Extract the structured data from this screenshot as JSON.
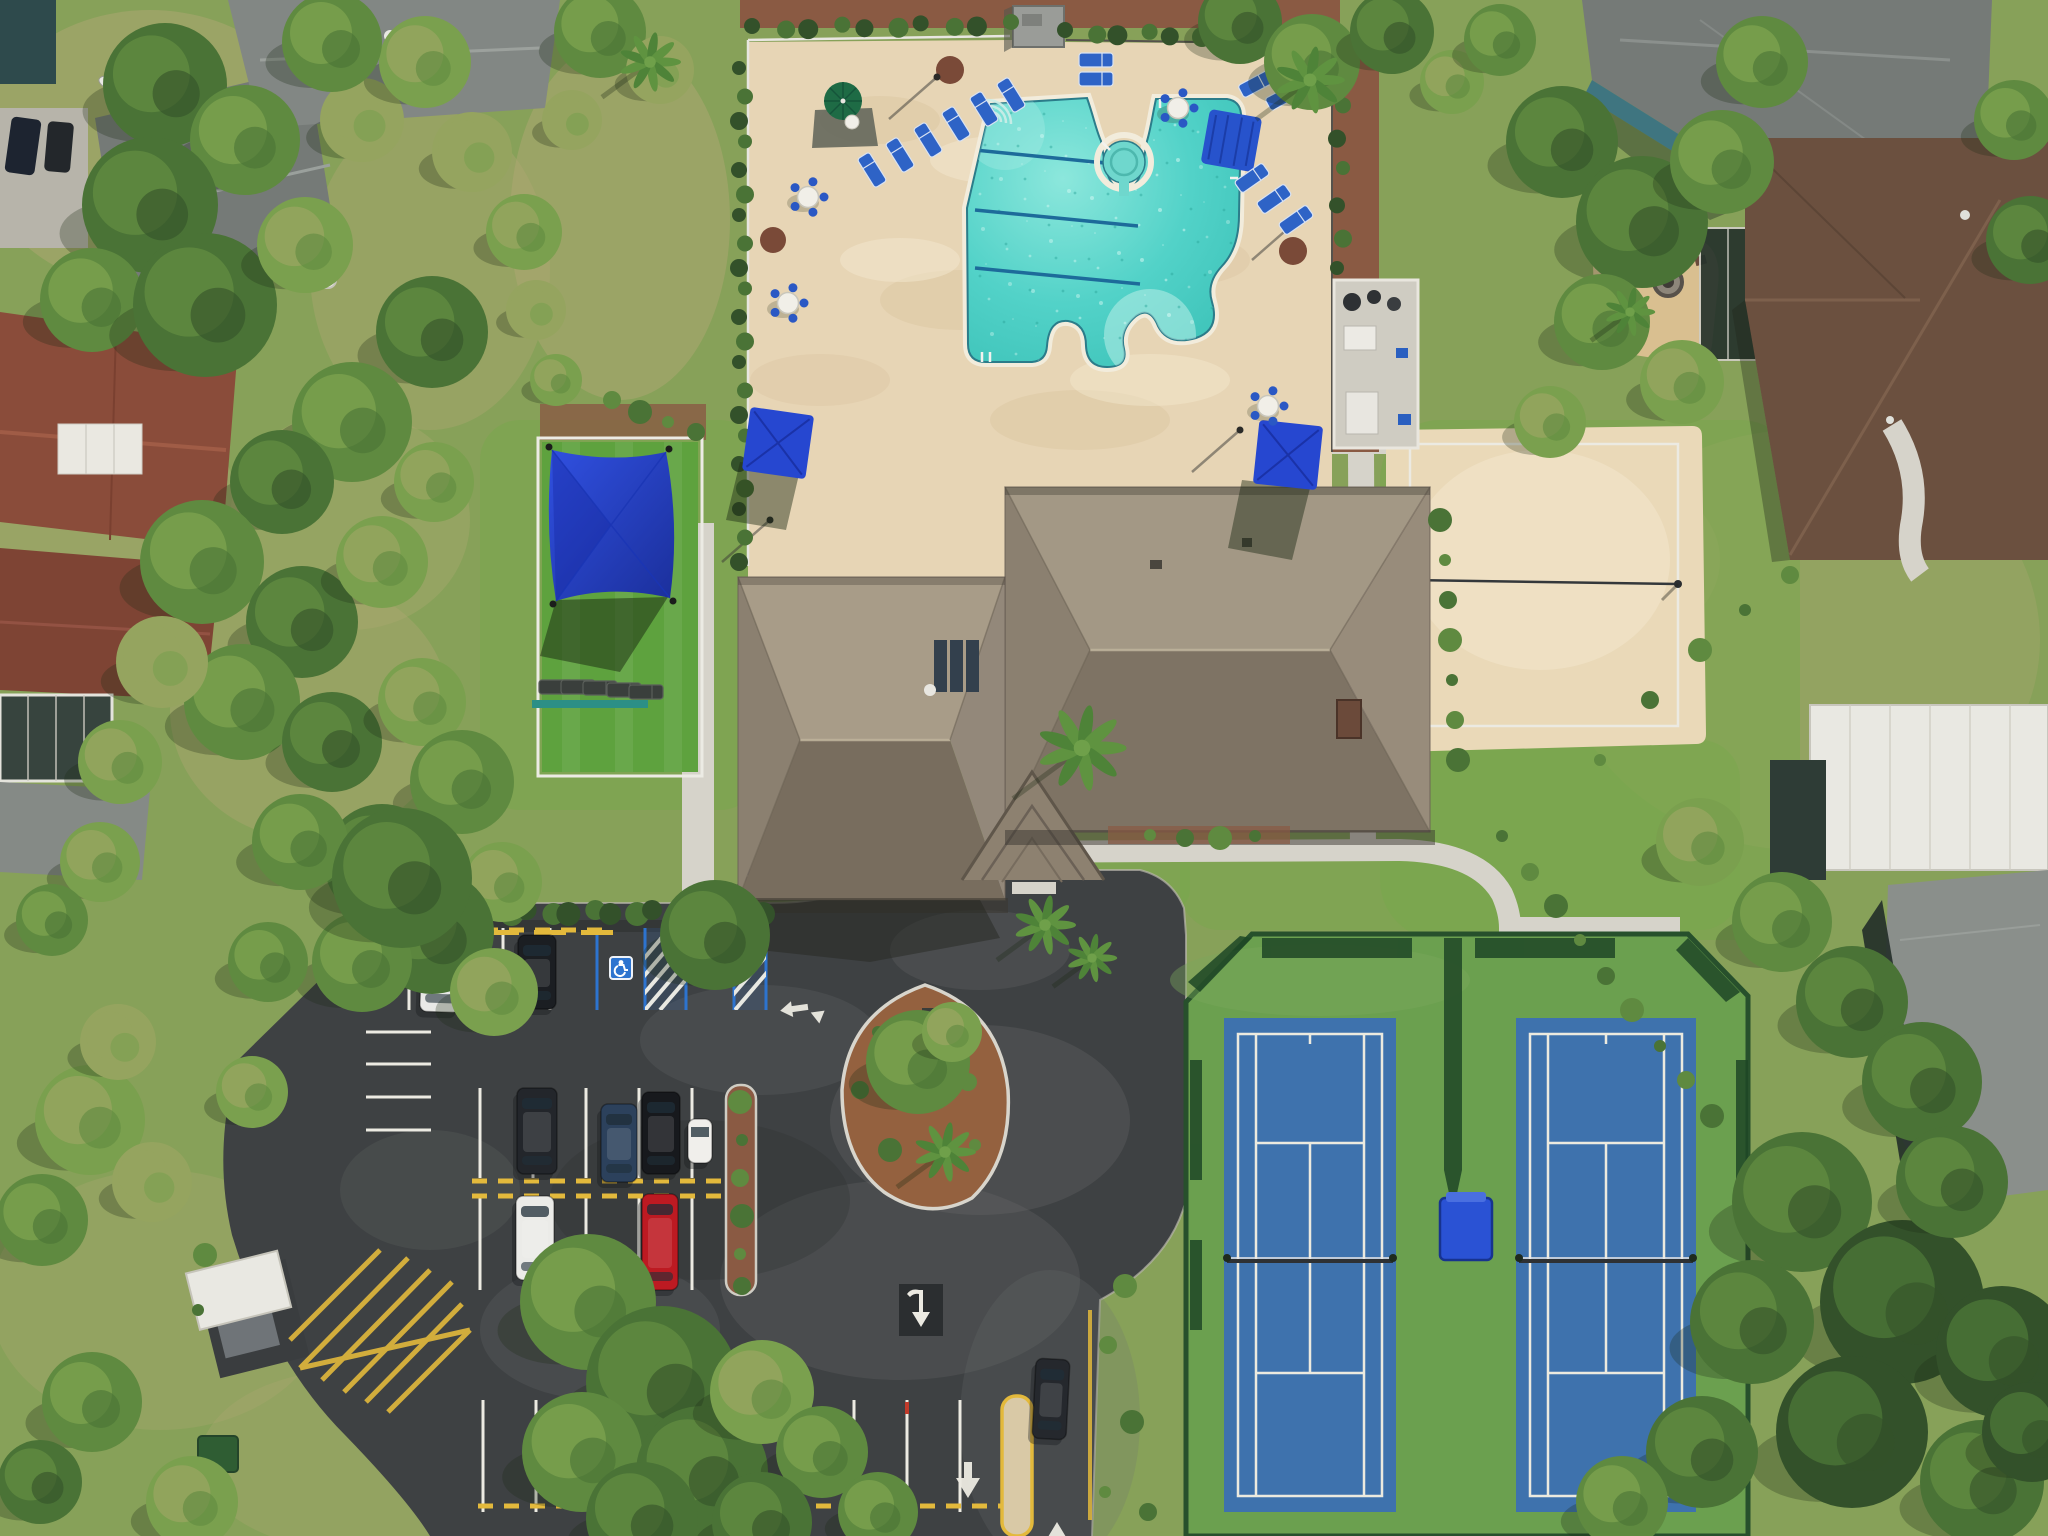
{
  "meta": {
    "type": "aerial-drone-photo",
    "description": "Overhead aerial view of a community amenity center: free-form swimming pool with lap lanes and spa on a tan deck, taupe hip-roof clubhouse, playground with blue shade sail, sand volleyball court, two blue tennis courts in a green enclosure, and an asphalt parking lot with cars, surrounded by residential houses and trees."
  },
  "colors": {
    "grass_base": "#87a159",
    "grass_bright": "#78a84c",
    "turf": "#5ea23e",
    "grass_dry": "#b0a873",
    "mulch": "#8a5a43",
    "deck": "#e7d5b5",
    "concrete": "#d6d3ca",
    "asphalt": "#3e4143",
    "asphalt_worn": "#6e7170",
    "line_white": "#eceae2",
    "line_yellow": "#e3b93c",
    "handicap_blue": "#2d74cf",
    "pool_water": "#52d2c8",
    "spa_water": "#6fd7cd",
    "lane_blue": "#1d6b9a",
    "coping": "#f2ecdc",
    "sand": "#ead9b8",
    "tennis_green": "#6ba04f",
    "tennis_blue": "#3e72ad",
    "fence_green": "#27502c",
    "roof_taupe": "#93887a",
    "roof_gray": "#757a77",
    "roof_brown": "#8a4c3a",
    "roof_dkbrown": "#6b503f",
    "white_struct": "#e9e8e2",
    "teal_wall": "#3f7580",
    "furniture_blue": "#2e63c6",
    "umbrella_royal": "#2647d0",
    "umbrella_green": "#1e6b45",
    "sail_blue": "#2b49d6"
  },
  "scene": {
    "amenities": [
      "swimming pool with 3 lap lanes",
      "round spa",
      "clubhouse",
      "playground with shade sail",
      "sand volleyball court",
      "two tennis courts",
      "parking lot",
      "gated pool deck"
    ],
    "pool": {
      "lap_lanes": 3,
      "loungers": [
        [
          872,
          170,
          -32
        ],
        [
          900,
          155,
          -32
        ],
        [
          928,
          140,
          -32
        ],
        [
          956,
          124,
          -32
        ],
        [
          984,
          109,
          -32
        ],
        [
          1011,
          95,
          -32
        ],
        [
          1096,
          60,
          90
        ],
        [
          1096,
          79,
          90
        ],
        [
          1256,
          84,
          62
        ],
        [
          1283,
          97,
          62
        ],
        [
          1252,
          178,
          55
        ],
        [
          1274,
          199,
          55
        ],
        [
          1296,
          220,
          55
        ]
      ],
      "tables": [
        [
          808,
          197
        ],
        [
          788,
          303
        ],
        [
          1178,
          108
        ],
        [
          1268,
          406
        ]
      ],
      "umbrellas": {
        "green_round": 1,
        "blue_square": 2,
        "blue_cabana": 1
      },
      "planter_circles": [
        [
          950,
          70,
          14
        ],
        [
          773,
          240,
          13
        ],
        [
          1293,
          251,
          14
        ]
      ],
      "light_poles": [
        [
          937,
          77
        ],
        [
          1300,
          218
        ],
        [
          770,
          520
        ],
        [
          1240,
          430
        ]
      ]
    },
    "playground": {
      "shade_sail": true,
      "loungers": [
        [
          556,
          687,
          90
        ],
        [
          578,
          687,
          90
        ],
        [
          600,
          688,
          90
        ],
        [
          624,
          690,
          90
        ],
        [
          646,
          692,
          90
        ]
      ]
    },
    "volleyball": {
      "surface": "sand",
      "net": true
    },
    "tennis": {
      "court_count": 2,
      "courts": [
        {
          "x": 1224,
          "w": 172
        },
        {
          "x": 1516,
          "w": 180
        }
      ],
      "y": 1018,
      "h": 494,
      "net_y": 1258,
      "divider_curtain": true,
      "ball_box": true
    },
    "parking": {
      "handicap_spaces": 2,
      "vehicles": [
        {
          "name": "white-sedan",
          "x": 441,
          "y": 974,
          "w": 40,
          "h": 76,
          "rot": 2,
          "color": "#e9e9e7"
        },
        {
          "name": "dark-sedan",
          "x": 537,
          "y": 972,
          "w": 38,
          "h": 74,
          "rot": 0,
          "color": "#1b1e22"
        },
        {
          "name": "black-suv",
          "x": 537,
          "y": 1131,
          "w": 40,
          "h": 86,
          "rot": 0,
          "color": "#23262b"
        },
        {
          "name": "blue-sedan",
          "x": 619,
          "y": 1143,
          "w": 36,
          "h": 78,
          "rot": 0,
          "color": "#2c415c"
        },
        {
          "name": "black-suv-2",
          "x": 661,
          "y": 1133,
          "w": 38,
          "h": 82,
          "rot": 0,
          "color": "#17191d"
        },
        {
          "name": "golf-cart",
          "x": 700,
          "y": 1141,
          "w": 24,
          "h": 44,
          "rot": 0,
          "color": "#f0efeb"
        },
        {
          "name": "white-sedan-2",
          "x": 535,
          "y": 1238,
          "w": 38,
          "h": 84,
          "rot": 0,
          "color": "#ebebe8"
        },
        {
          "name": "red-truck",
          "x": 660,
          "y": 1242,
          "w": 36,
          "h": 96,
          "rot": 0,
          "color": "#bd1a22"
        },
        {
          "name": "exiting-car",
          "x": 1051,
          "y": 1399,
          "w": 34,
          "h": 80,
          "rot": 3,
          "color": "#25282d"
        }
      ],
      "rows": {
        "top": {
          "y1": 928,
          "y2": 1010,
          "x": [
            409,
            456,
            503,
            550
          ]
        },
        "top_blue": {
          "y1": 928,
          "y2": 1010,
          "x": [
            597,
            645,
            686,
            734,
            766
          ],
          "hatch": [
            [
              645,
              686
            ],
            [
              734,
              766
            ]
          ],
          "icons": [
            621,
            710
          ]
        },
        "mid_upper": {
          "y1": 1088,
          "y2": 1178,
          "x": [
            480,
            533,
            586,
            639,
            692,
            745
          ]
        },
        "mid_lower": {
          "y1": 1198,
          "y2": 1290,
          "x": [
            480,
            533,
            586,
            639,
            692,
            745
          ]
        },
        "bottom": {
          "y1": 1400,
          "y2": 1512,
          "x": [
            483,
            536,
            589,
            642,
            695,
            748,
            801,
            854,
            907,
            960
          ]
        },
        "west": {
          "x1": 366,
          "x2": 431,
          "ys": [
            1032,
            1064,
            1097,
            1130
          ]
        }
      },
      "yellow_dashes": [
        {
          "y": 930,
          "x1": 405,
          "x2": 596
        },
        {
          "y": 1181,
          "x1": 472,
          "x2": 750
        },
        {
          "y": 1196,
          "x1": 472,
          "x2": 750
        },
        {
          "y": 1506,
          "x1": 478,
          "x2": 1006
        }
      ],
      "pavement_arrows": 4,
      "speed_bump": true,
      "dumpster_enclosure": true
    },
    "vegetation": {
      "trees": [
        [
          165,
          85,
          62,
          1
        ],
        [
          245,
          140,
          55,
          2
        ],
        [
          150,
          205,
          68,
          1
        ],
        [
          92,
          300,
          52,
          2
        ],
        [
          205,
          305,
          72,
          1
        ],
        [
          305,
          245,
          48,
          3
        ],
        [
          362,
          120,
          42,
          4
        ],
        [
          425,
          62,
          46,
          3
        ],
        [
          332,
          42,
          50,
          2
        ],
        [
          472,
          152,
          40,
          4
        ],
        [
          524,
          232,
          38,
          3
        ],
        [
          432,
          332,
          56,
          1
        ],
        [
          352,
          422,
          60,
          2
        ],
        [
          282,
          482,
          52,
          1
        ],
        [
          202,
          562,
          62,
          2
        ],
        [
          302,
          622,
          56,
          1
        ],
        [
          382,
          562,
          46,
          3
        ],
        [
          434,
          482,
          40,
          3
        ],
        [
          242,
          702,
          58,
          2
        ],
        [
          332,
          742,
          50,
          1
        ],
        [
          422,
          702,
          44,
          3
        ],
        [
          162,
          662,
          46,
          4
        ],
        [
          120,
          762,
          42,
          3
        ],
        [
          462,
          782,
          52,
          2
        ],
        [
          382,
          862,
          58,
          1
        ],
        [
          300,
          842,
          48,
          2
        ],
        [
          502,
          882,
          40,
          3
        ],
        [
          432,
          932,
          62,
          1
        ],
        [
          362,
          962,
          50,
          2
        ],
        [
          494,
          992,
          44,
          3
        ],
        [
          402,
          878,
          70,
          1
        ],
        [
          90,
          1120,
          55,
          3
        ],
        [
          42,
          1220,
          46,
          2
        ],
        [
          152,
          1182,
          40,
          4
        ],
        [
          252,
          1092,
          36,
          3
        ],
        [
          92,
          1402,
          50,
          2
        ],
        [
          40,
          1482,
          42,
          1
        ],
        [
          192,
          1502,
          46,
          3
        ],
        [
          118,
          1042,
          38,
          4
        ],
        [
          588,
          1302,
          68,
          2
        ],
        [
          662,
          1382,
          76,
          1
        ],
        [
          582,
          1452,
          60,
          2
        ],
        [
          702,
          1472,
          66,
          1
        ],
        [
          762,
          1392,
          52,
          3
        ],
        [
          642,
          1518,
          56,
          1
        ],
        [
          822,
          1452,
          46,
          2
        ],
        [
          762,
          1522,
          50,
          1
        ],
        [
          878,
          1512,
          40,
          2
        ],
        [
          918,
          1062,
          52,
          2
        ],
        [
          952,
          1032,
          30,
          3
        ],
        [
          600,
          32,
          46,
          2
        ],
        [
          660,
          70,
          34,
          4
        ],
        [
          572,
          120,
          30,
          4
        ],
        [
          536,
          310,
          30,
          4
        ],
        [
          556,
          380,
          26,
          3
        ],
        [
          1240,
          22,
          42,
          1
        ],
        [
          1312,
          62,
          48,
          2
        ],
        [
          1392,
          32,
          42,
          1
        ],
        [
          1452,
          82,
          32,
          3
        ],
        [
          1500,
          40,
          36,
          2
        ],
        [
          1562,
          142,
          56,
          1
        ],
        [
          1642,
          222,
          66,
          1
        ],
        [
          1722,
          162,
          52,
          2
        ],
        [
          1602,
          322,
          48,
          2
        ],
        [
          1682,
          382,
          42,
          3
        ],
        [
          1550,
          422,
          36,
          3
        ],
        [
          1762,
          62,
          46,
          2
        ],
        [
          2014,
          120,
          40,
          2
        ],
        [
          2030,
          240,
          44,
          1
        ],
        [
          1700,
          842,
          44,
          3
        ],
        [
          1782,
          922,
          50,
          2
        ],
        [
          1852,
          1002,
          56,
          1
        ],
        [
          1922,
          1082,
          60,
          1
        ],
        [
          1802,
          1202,
          70,
          1
        ],
        [
          1902,
          1302,
          82,
          0
        ],
        [
          1752,
          1322,
          62,
          1
        ],
        [
          1852,
          1432,
          76,
          0
        ],
        [
          1952,
          1182,
          56,
          1
        ],
        [
          2002,
          1352,
          66,
          0
        ],
        [
          1702,
          1452,
          56,
          1
        ],
        [
          1982,
          1482,
          62,
          1
        ],
        [
          1622,
          1502,
          46,
          2
        ],
        [
          2032,
          1432,
          50,
          0
        ],
        [
          715,
          935,
          55,
          1
        ],
        [
          100,
          862,
          40,
          3
        ],
        [
          52,
          920,
          36,
          2
        ],
        [
          268,
          962,
          40,
          2
        ]
      ],
      "palms": [
        [
          1082,
          748,
          46
        ],
        [
          1310,
          80,
          36
        ],
        [
          945,
          1152,
          32
        ],
        [
          650,
          62,
          32
        ],
        [
          1045,
          925,
          32
        ],
        [
          1092,
          958,
          26
        ],
        [
          1630,
          312,
          26
        ]
      ],
      "shrubs": [
        [
          1502,
          836
        ],
        [
          1530,
          872
        ],
        [
          1556,
          906
        ],
        [
          1580,
          940
        ],
        [
          1606,
          976
        ],
        [
          1632,
          1010
        ],
        [
          1660,
          1046
        ],
        [
          1686,
          1080
        ],
        [
          1712,
          1116
        ],
        [
          1600,
          760
        ],
        [
          1650,
          700
        ],
        [
          1700,
          650
        ],
        [
          1745,
          610
        ],
        [
          1790,
          575
        ],
        [
          1440,
          520
        ],
        [
          1445,
          560
        ],
        [
          1448,
          600
        ],
        [
          1450,
          640
        ],
        [
          1452,
          680
        ],
        [
          1455,
          720
        ],
        [
          1458,
          760
        ],
        [
          1150,
          835
        ],
        [
          1185,
          838
        ],
        [
          1220,
          838
        ],
        [
          1255,
          836
        ],
        [
          1108,
          1345
        ],
        [
          1132,
          1422
        ],
        [
          1105,
          1492
        ],
        [
          1148,
          1512
        ],
        [
          1125,
          1286
        ],
        [
          878,
          1032
        ],
        [
          968,
          1082
        ],
        [
          890,
          1150
        ],
        [
          975,
          1145
        ],
        [
          860,
          1090
        ],
        [
          740,
          1102
        ],
        [
          742,
          1140
        ],
        [
          740,
          1178
        ],
        [
          742,
          1216
        ],
        [
          740,
          1254
        ],
        [
          742,
          1286
        ],
        [
          205,
          1255
        ],
        [
          198,
          1310
        ],
        [
          612,
          400
        ],
        [
          640,
          412
        ],
        [
          668,
          422
        ],
        [
          696,
          432
        ]
      ],
      "hedge_rows": [
        {
          "x1": 742,
          "y1": 70,
          "x2": 742,
          "y2": 560,
          "step": 24,
          "r": 7
        },
        {
          "x1": 755,
          "y1": 28,
          "x2": 1008,
          "y2": 24,
          "step": 26,
          "r": 8
        },
        {
          "x1": 1068,
          "y1": 32,
          "x2": 1330,
          "y2": 38,
          "step": 26,
          "r": 8
        },
        {
          "x1": 1340,
          "y1": 70,
          "x2": 1340,
          "y2": 270,
          "step": 30,
          "r": 7
        },
        {
          "x1": 404,
          "y1": 912,
          "x2": 676,
          "y2": 912,
          "step": 20,
          "r": 10
        },
        {
          "x1": 722,
          "y1": 912,
          "x2": 766,
          "y2": 912,
          "step": 20,
          "r": 10
        }
      ]
    },
    "houses": {
      "top_left_gray_roofs": 2,
      "left_brown_roofs": 2,
      "top_right_house": "gray shingle roof, teal walls, paver patio with fire pit",
      "right_brown_roof_house": 1,
      "bottom_right": "white lanai roof and dark screened enclosure"
    }
  }
}
